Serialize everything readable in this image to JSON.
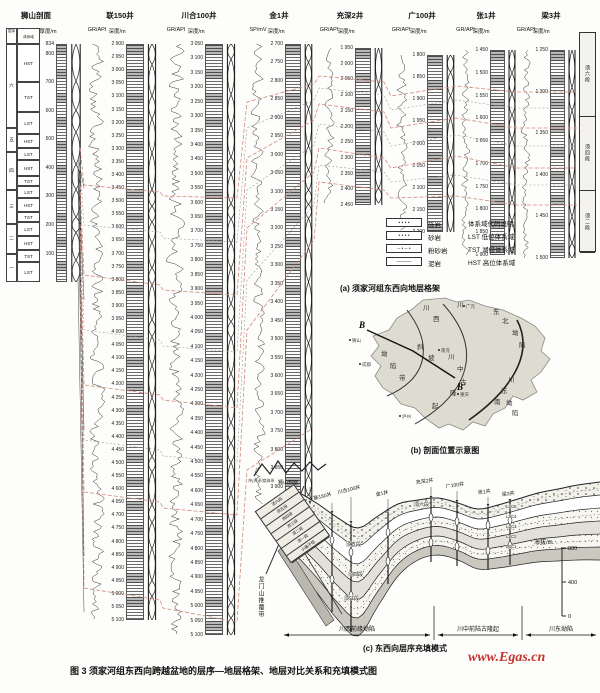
{
  "figure": {
    "caption": "图 3  须家河组东西向跨越盆地的层序—地层格架、地层对比关系和充填模式图",
    "watermark": "www.Egas.cn"
  },
  "panel_a": {
    "caption": "(a) 须家河组东西向地层格架",
    "section": {
      "name": "狮山剖面",
      "scale_label": "厚度/m",
      "col_headers": [
        "层序",
        "体系域"
      ],
      "sequence_groups": [
        "六",
        "五",
        "四",
        "三",
        "二",
        "一"
      ],
      "tract_rows": [
        "HST",
        "TST",
        "LST",
        "HST",
        "LST",
        "HST",
        "TST",
        "LST",
        "HST",
        "TST",
        "LST",
        "HST",
        "TST",
        "LST"
      ],
      "ticks": [
        "834",
        "800",
        "700",
        "600",
        "500",
        "400",
        "300",
        "200",
        "100"
      ]
    },
    "wells": [
      {
        "name": "联150井",
        "curve": "GR/API",
        "depth": "深度/m",
        "ticks": [
          2900,
          2950,
          3000,
          3050,
          3100,
          3150,
          3200,
          3250,
          3300,
          3350,
          3400,
          3450,
          3500,
          3550,
          3600,
          3650,
          3700,
          3750,
          3800,
          3850,
          3900,
          3950,
          4000,
          4050,
          4100,
          4150,
          4200,
          4250,
          4300,
          4350,
          4400,
          4450,
          4500,
          4550,
          4600,
          4650,
          4700,
          4750,
          4800,
          4850,
          4900,
          4950,
          5000,
          5050,
          5100
        ]
      },
      {
        "name": "川合100井",
        "curve": "GR/API",
        "depth": "深度/m",
        "ticks": [
          3050,
          3100,
          3150,
          3200,
          3250,
          3300,
          3350,
          3400,
          3450,
          3500,
          3550,
          3600,
          3650,
          3700,
          3750,
          3800,
          3850,
          3900,
          3950,
          4000,
          4050,
          4100,
          4150,
          4200,
          4250,
          4300,
          4350,
          4400,
          4450,
          4500,
          4550,
          4600,
          4650,
          4700,
          4750,
          4800,
          4850,
          4900,
          4950,
          5000,
          5050,
          5100
        ]
      },
      {
        "name": "金1井",
        "curve": "SP/mV",
        "depth": "深度/m",
        "ticks": [
          2700,
          2750,
          2800,
          2850,
          2900,
          2950,
          3000,
          3050,
          3100,
          3150,
          3200,
          3250,
          3300,
          3350,
          3400,
          3450,
          3500,
          3550,
          3600,
          3650,
          3700,
          3750,
          3800,
          3850,
          3900,
          3950
        ]
      },
      {
        "name": "充深2井",
        "curve": "GR/API",
        "depth": "深度/m",
        "ticks": [
          1950,
          2000,
          2050,
          2100,
          2150,
          2200,
          2250,
          2300,
          2350,
          2400,
          2450
        ]
      },
      {
        "name": "广100井",
        "curve": "GR/API",
        "depth": "深度/m",
        "ticks": [
          1800,
          1850,
          1900,
          1950,
          2000,
          2050,
          2100,
          2150,
          2200
        ]
      },
      {
        "name": "张1井",
        "curve": "GR/API",
        "depth": "深度/m",
        "ticks": [
          1450,
          1500,
          1550,
          1600,
          1650,
          1700,
          1750,
          1800,
          1850,
          1900
        ]
      },
      {
        "name": "梁3井",
        "curve": "GR/API",
        "depth": "深度/m",
        "ticks": [
          1250,
          1300,
          1350,
          1400,
          1450,
          1500
        ],
        "members": [
          "须六段",
          "须四段",
          "须二段"
        ]
      }
    ],
    "legend": {
      "lithology": [
        {
          "label": "砾岩"
        },
        {
          "label": "砂岩"
        },
        {
          "label": "粉砂岩"
        },
        {
          "label": "泥岩"
        }
      ],
      "tract_title": "体系域代码说明:",
      "tracts": [
        "LST 低位体系域",
        "TST 湖侵体系域",
        "HST 高位体系域"
      ]
    }
  },
  "panel_b": {
    "caption": "(b) 剖面位置示意图",
    "endpoints": {
      "start": "B",
      "end": "B′"
    },
    "region_chars": [
      {
        "t": "川",
        "x": 78,
        "y": 8
      },
      {
        "t": "西",
        "x": 88,
        "y": 19
      },
      {
        "t": "坳",
        "x": 36,
        "y": 54
      },
      {
        "t": "陷",
        "x": 45,
        "y": 66
      },
      {
        "t": "带",
        "x": 54,
        "y": 78
      },
      {
        "t": "斜",
        "x": 72,
        "y": 47
      },
      {
        "t": "坡",
        "x": 83,
        "y": 58
      },
      {
        "t": "川",
        "x": 112,
        "y": 5
      },
      {
        "t": "东",
        "x": 148,
        "y": 12
      },
      {
        "t": "北",
        "x": 157,
        "y": 21
      },
      {
        "t": "坳",
        "x": 167,
        "y": 33
      },
      {
        "t": "陷",
        "x": 174,
        "y": 45
      },
      {
        "t": "川",
        "x": 103,
        "y": 57
      },
      {
        "t": "中",
        "x": 112,
        "y": 69
      },
      {
        "t": "古",
        "x": 115,
        "y": 82
      },
      {
        "t": "隆",
        "x": 105,
        "y": 93
      },
      {
        "t": "起",
        "x": 87,
        "y": 106
      },
      {
        "t": "川",
        "x": 163,
        "y": 80
      },
      {
        "t": "东",
        "x": 156,
        "y": 91
      },
      {
        "t": "南",
        "x": 149,
        "y": 102
      },
      {
        "t": "坳",
        "x": 161,
        "y": 103
      },
      {
        "t": "陷",
        "x": 167,
        "y": 113
      }
    ],
    "cities": [
      {
        "n": "狮山",
        "x": 4,
        "y": 42
      },
      {
        "n": "广元",
        "x": 118,
        "y": 8
      },
      {
        "n": "南充",
        "x": 93,
        "y": 52
      },
      {
        "n": "成都",
        "x": 14,
        "y": 66
      },
      {
        "n": "重庆",
        "x": 112,
        "y": 96
      },
      {
        "n": "泸州",
        "x": 54,
        "y": 118
      }
    ]
  },
  "panel_c": {
    "caption": "(c) 东西向层序充填模式",
    "well_labels": [
      "狮山剖面",
      "联150井",
      "川合100井",
      "金1井",
      "充深2井",
      "广100井",
      "张1井",
      "梁3井"
    ],
    "member_labels": [
      "须六段",
      "须五段",
      "须四段",
      "须三段"
    ],
    "sequence_labels": [
      "LSC5",
      "LSC4",
      "LSC3",
      "LSC2",
      "LSC1"
    ],
    "elevation": {
      "label": "海拔/m",
      "ticks": [
        "800",
        "400",
        "0"
      ]
    },
    "zones": [
      "川西前缘坳陷",
      "川中前陆古隆起",
      "川东坳陷"
    ],
    "thrust_label": "龙门山推覆带",
    "fan_label": "冲(洪)积扇体系",
    "left_table": [
      "须六段",
      "须五段",
      "须四段",
      "须三段",
      "须二段",
      "须一段",
      "小塘子组"
    ]
  }
}
